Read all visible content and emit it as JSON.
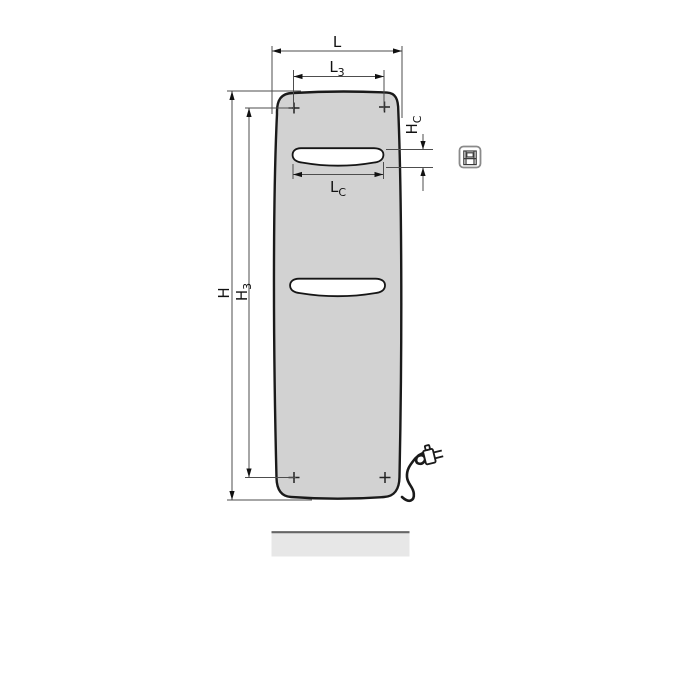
{
  "drawing": {
    "title": "panel-radiator-front-view-dimension-drawing",
    "labels": {
      "l": {
        "main": "L",
        "sub": ""
      },
      "l3": {
        "main": "L",
        "sub": "3"
      },
      "lc": {
        "main": "L",
        "sub": "C"
      },
      "h": {
        "main": "H",
        "sub": ""
      },
      "h3": {
        "main": "H",
        "sub": "3"
      },
      "hc": {
        "main": "H",
        "sub": "C"
      }
    },
    "marks": {
      "mounting_points": 4
    },
    "icons": [
      "panel-radiator-product-icon",
      "power-plug-icon"
    ],
    "colors": {
      "panel_fill": "#d2d2d2",
      "outline": "#1a1a1a",
      "dimension_line": "#4d4d4d",
      "text": "#111111",
      "floor_fill": "#e7e7e7",
      "floor_edge": "#666666",
      "icon_border": "#8a8a8a"
    }
  }
}
